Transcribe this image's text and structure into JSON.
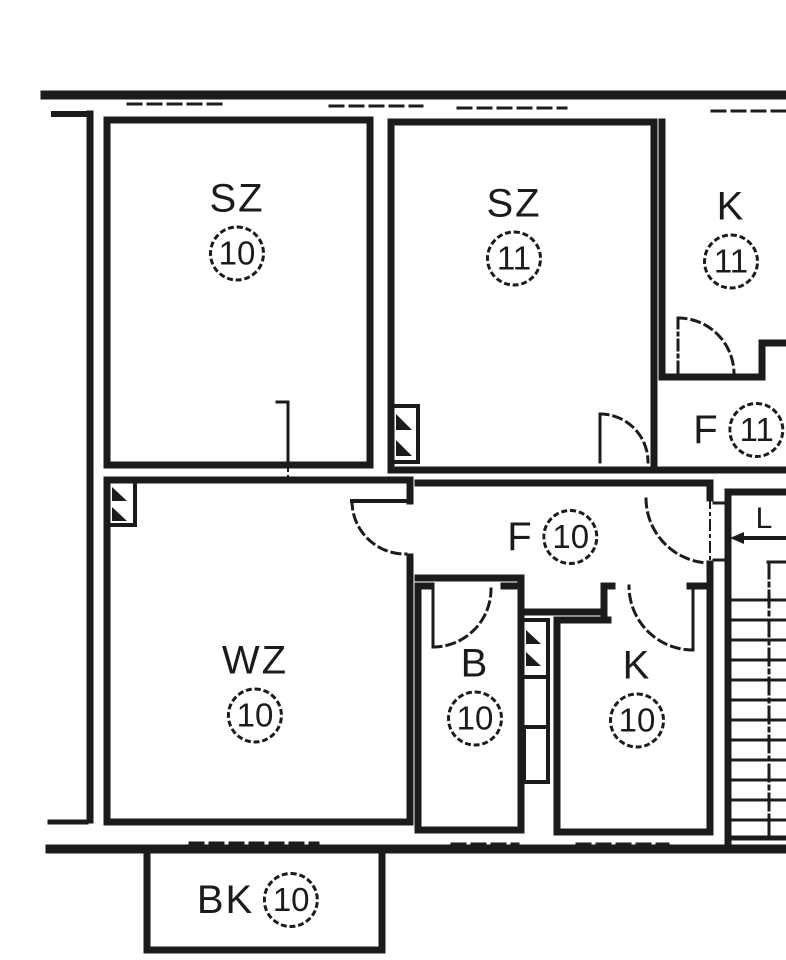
{
  "plan": {
    "type": "floor-plan",
    "rooms": [
      {
        "key": "sz10",
        "label": "SZ",
        "number": "10"
      },
      {
        "key": "sz11",
        "label": "SZ",
        "number": "11"
      },
      {
        "key": "k11",
        "label": "K",
        "number": "11"
      },
      {
        "key": "f11",
        "label": "F",
        "number": "11"
      },
      {
        "key": "wz10",
        "label": "WZ",
        "number": "10"
      },
      {
        "key": "f10",
        "label": "F",
        "number": "10"
      },
      {
        "key": "b10",
        "label": "B",
        "number": "10"
      },
      {
        "key": "k10",
        "label": "K",
        "number": "10"
      },
      {
        "key": "bk10",
        "label": "BK",
        "number": "10"
      }
    ],
    "stairs": {
      "label": "L"
    },
    "colors": {
      "ink": "#1b1b1b",
      "paper": "#ffffff"
    }
  }
}
